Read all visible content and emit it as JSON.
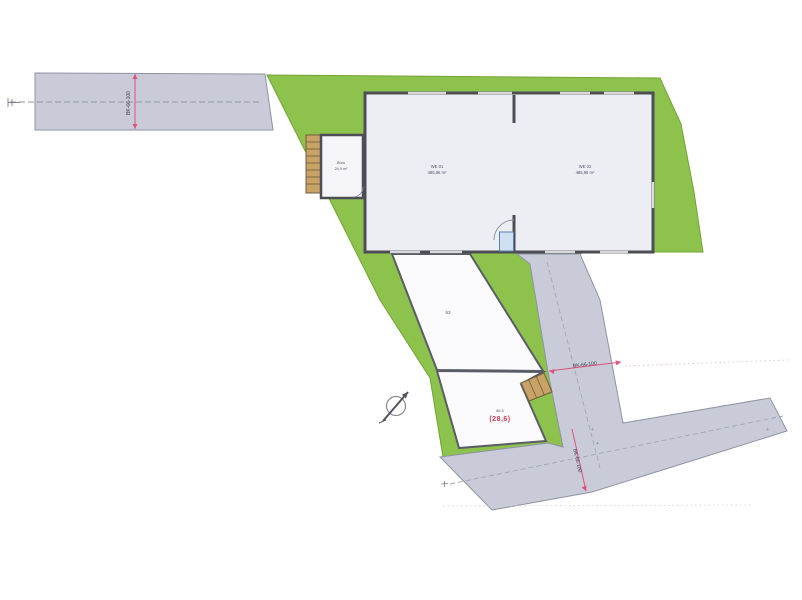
{
  "plan": {
    "building": {
      "hall_left": {
        "line1": "WE 01",
        "line2": "485,96 m²"
      },
      "hall_right": {
        "line1": "WE 02",
        "line2": "485,96 m²"
      },
      "annex": {
        "line1": "Büro",
        "line2": "24,9 m²"
      }
    },
    "parcels": {
      "upper_label": "63",
      "lower_gray": "86,5",
      "lower_red": "(28,6)"
    },
    "dims": {
      "top_road": "BK-66-100",
      "diag_road": "BK-66-100",
      "bottom_road": "BK-66-100"
    },
    "marks": {
      "plus_a": "+",
      "plus_b": "+",
      "plus_c": "+"
    },
    "colors": {
      "green": "#8dc24c",
      "road": "#c9ccd8",
      "road_edge": "#8e93a4",
      "building_fill": "#ededf4",
      "parcel_fill": "#fbfbfd",
      "wall": "#4d4d55",
      "dim_red": "#e0507a",
      "stair_tan": "#c9a266",
      "label_red": "#d33a52"
    }
  }
}
